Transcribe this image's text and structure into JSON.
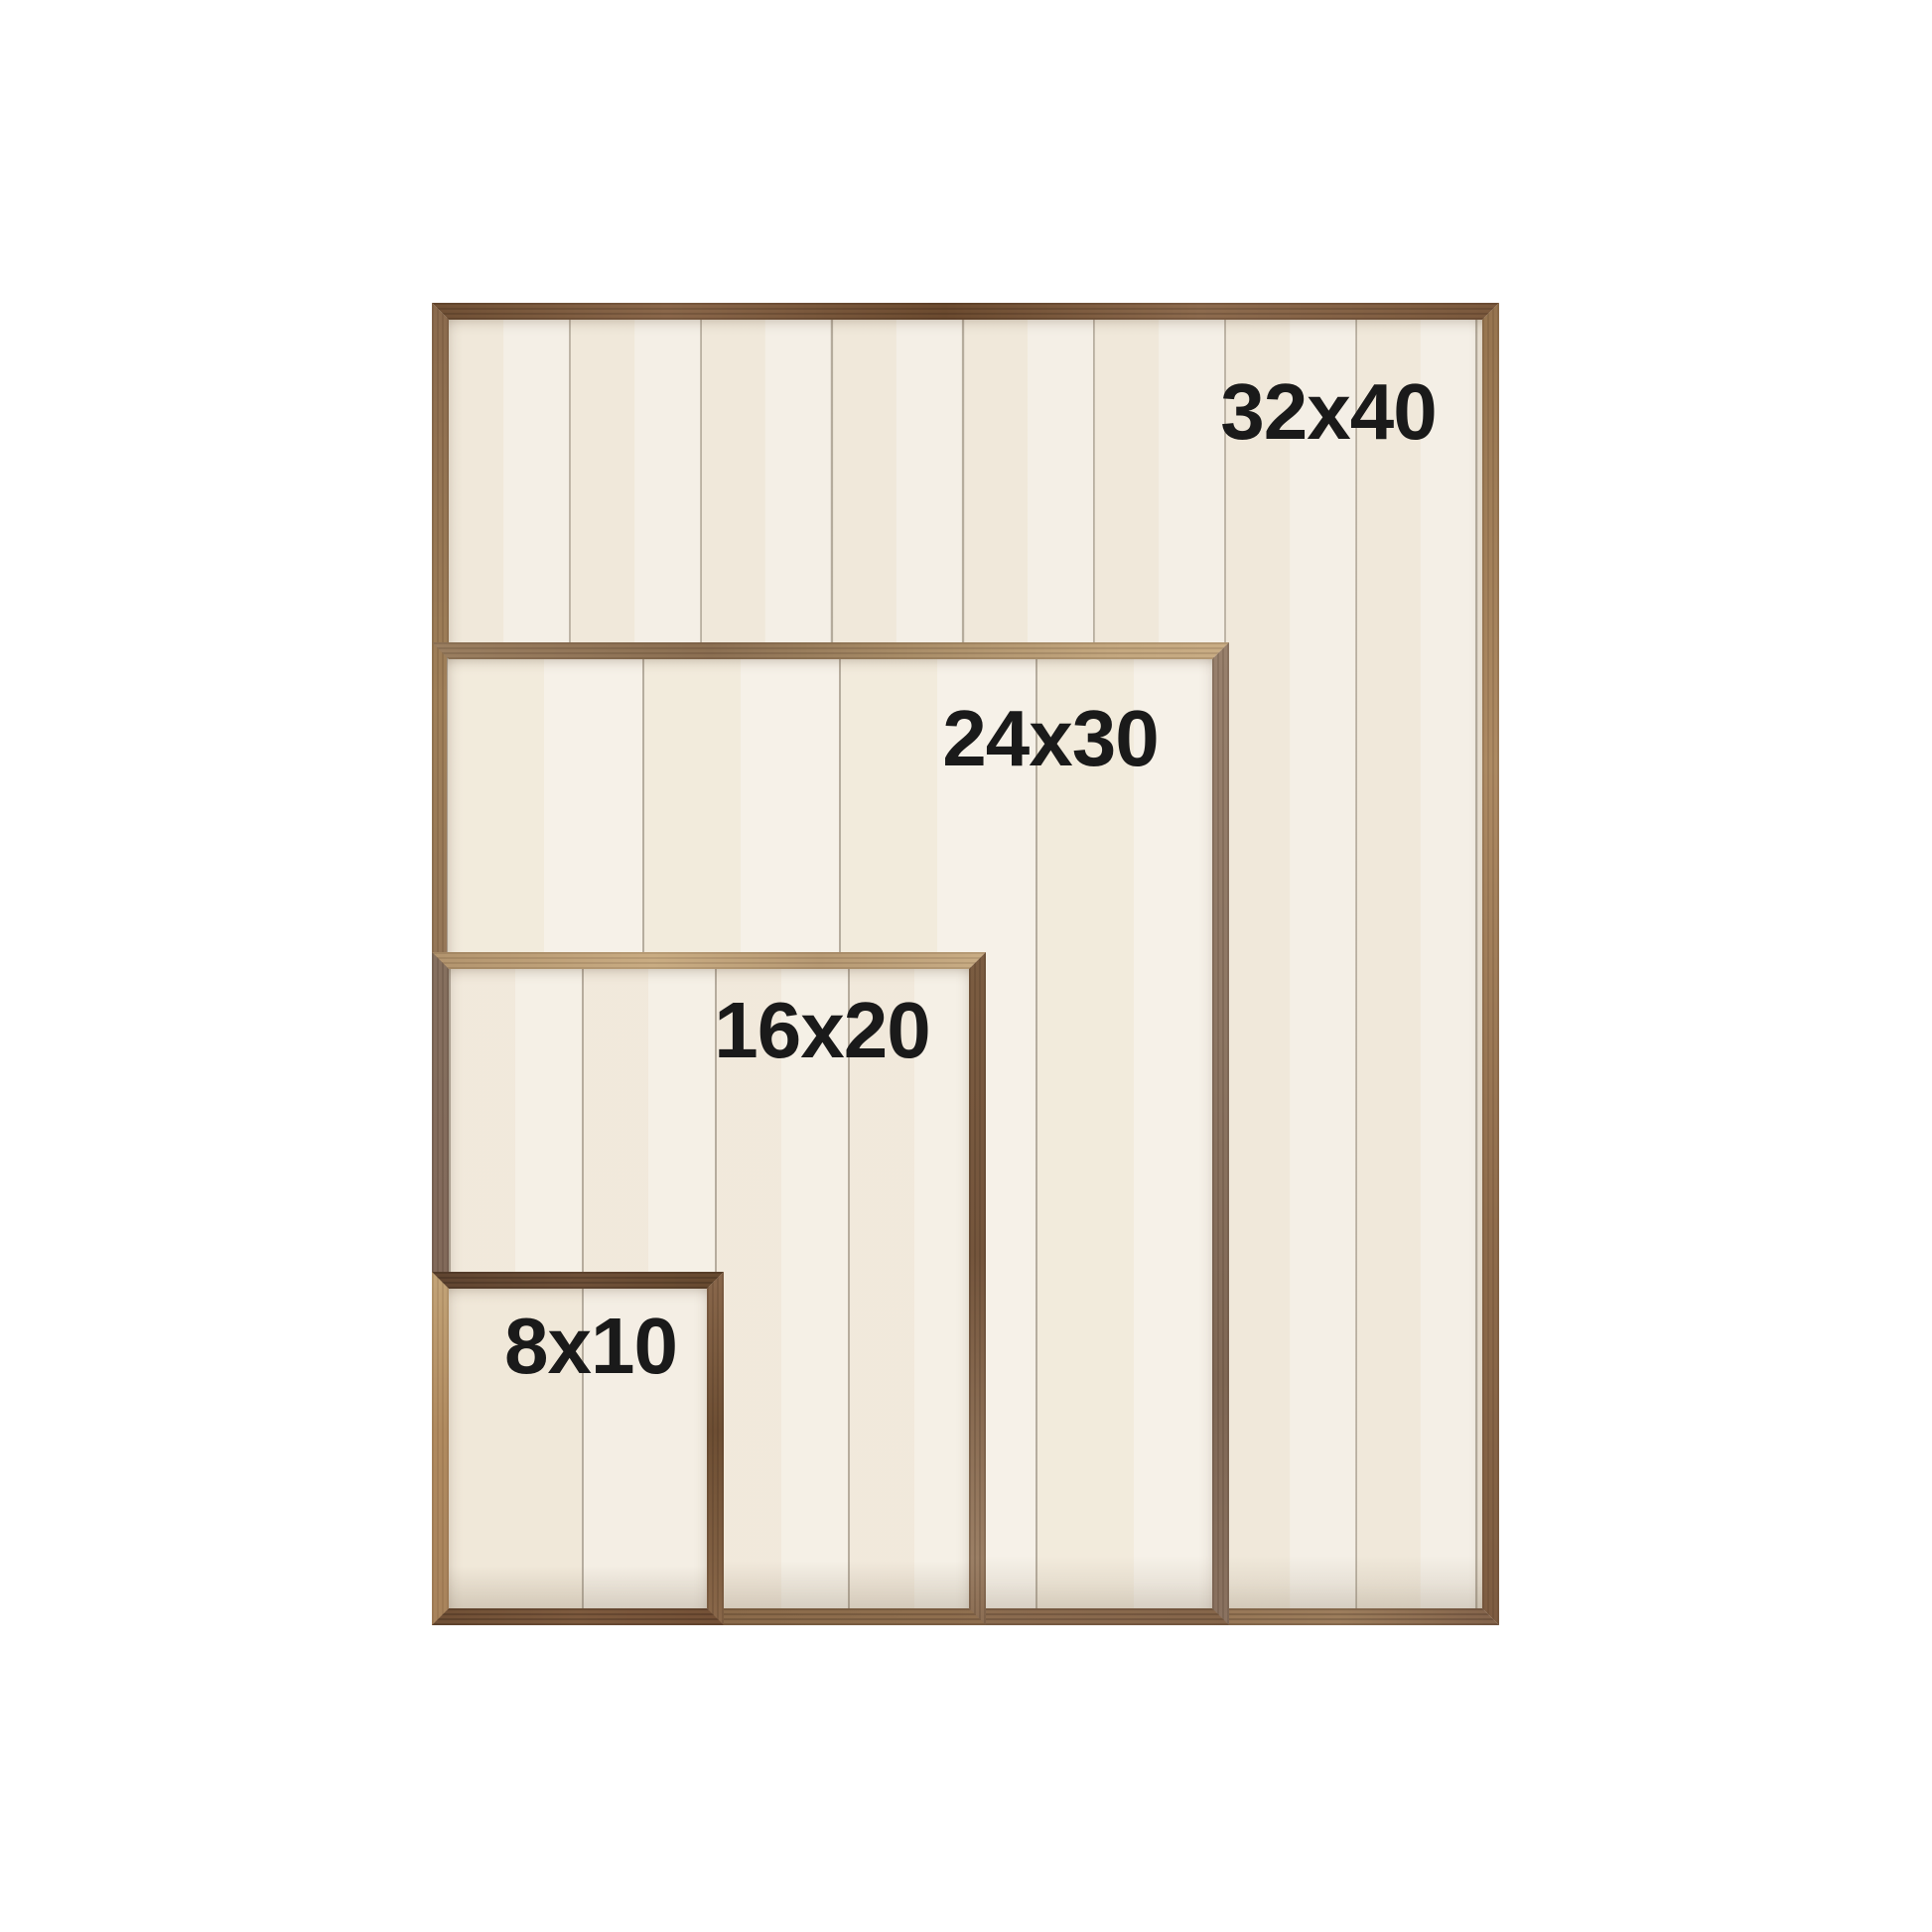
{
  "canvas": {
    "background": "#ffffff",
    "description_visible_text_only": "size comparison of four wood framed shiplap sign blanks"
  },
  "frames": [
    {
      "id": "32x40",
      "label": "32x40"
    },
    {
      "id": "24x30",
      "label": "24x30"
    },
    {
      "id": "16x20",
      "label": "16x20"
    },
    {
      "id": "8x10",
      "label": "8x10"
    }
  ],
  "colors": {
    "label_text": "#1a1a1a",
    "panel_cream": "#f2ecdf",
    "plank_seam": "#a79f90",
    "wood_walnut_dark": "#74533a",
    "wood_walnut_mid": "#8a684a",
    "wood_tan_light": "#c9ad85",
    "wood_gray_brown": "#8d7663"
  }
}
